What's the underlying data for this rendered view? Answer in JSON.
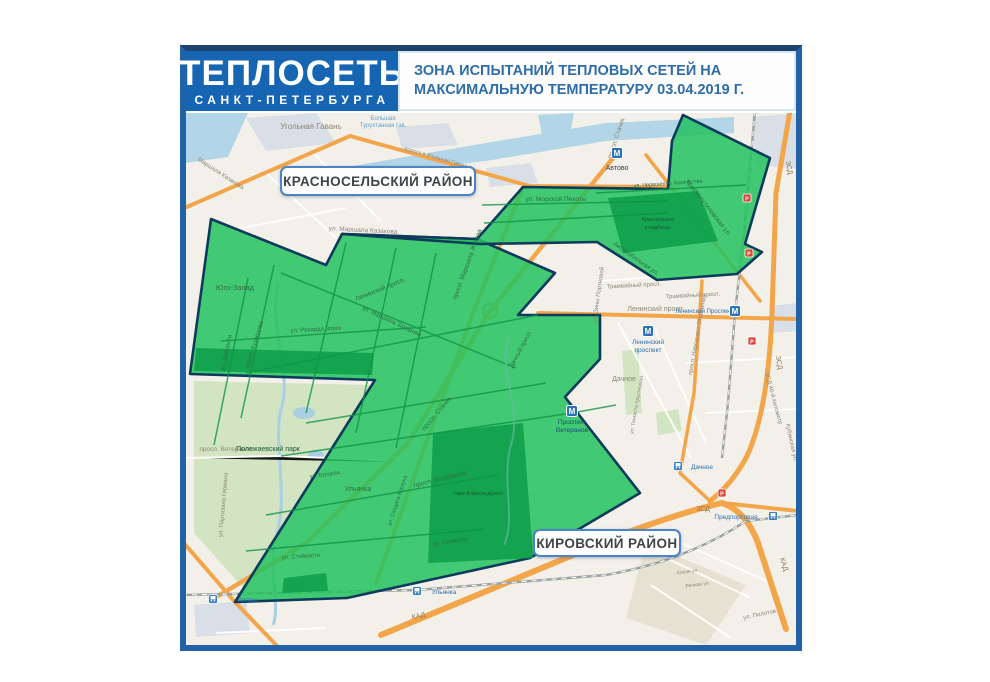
{
  "header": {
    "logo_line1": "ТЕПЛОСЕТЬ",
    "logo_line2": "САНКТ-ПЕТЕРБУРГА",
    "title": "ЗОНА ИСПЫТАНИЙ ТЕПЛОВЫХ СЕТЕЙ НА МАКСИМАЛЬНУЮ ТЕМПЕРАТУРУ 03.04.2019 Г."
  },
  "colors": {
    "header_blue": "#1565b2",
    "frame_blue": "#2262a7",
    "title_text": "#2e6da9",
    "zone_fill": "#22c25e",
    "zone_stroke": "#0e3a5c",
    "park_in_zone": "#0f9f4a",
    "road_orange": "#f3a54a",
    "water": "#b3d5e8",
    "label_gray": "#8d8779",
    "label_water": "#699fc6",
    "label_ingreen": "#2d6e46",
    "label_darkgreen": "#1c5a35",
    "label_station": "#2f6fad",
    "label_stationdark": "#1a4e78",
    "label_road": "#8a7a52",
    "label_text": "#3c3c3c",
    "marker_red": "#d84336"
  },
  "districts": [
    {
      "name": "КРАСНОСЕЛЬСКИЙ РАЙОН",
      "x": 94,
      "y": 53,
      "w": 196,
      "h": 30
    },
    {
      "name": "КИРОВСКИЙ РАЙОН",
      "x": 347,
      "y": 416,
      "w": 148,
      "h": 28
    }
  ],
  "zone": {
    "polygons": [
      {
        "name": "test-zone-main",
        "points": "25,106 140,152 156,121 291,126 369,160 332,202 414,202 414,246 379,284 454,380 344,445 161,485 49,489 189,267 4,261"
      },
      {
        "name": "test-zone-band-arm",
        "points": "156,121 291,126 337,74 482,76 486,28 497,2 584,45 559,131 576,139 551,161 471,167 411,129 294,131"
      }
    ],
    "parks": [
      {
        "name": "krasnenkoe-cemetery",
        "points": "422,85 512,78 532,128 437,140"
      },
      {
        "name": "alexandrino-park",
        "points": "247,320 337,310 347,445 242,450"
      },
      {
        "name": "polezhaevsky-north",
        "points": "10,235 188,240 186,262 8,258"
      },
      {
        "name": "ulyanka-grove",
        "points": "98,465 140,460 142,478 96,480"
      }
    ]
  },
  "map": {
    "labels": [
      {
        "t": "Угольная Гавань",
        "x": 125,
        "y": 16,
        "r": 0,
        "c": "gray",
        "s": 8
      },
      {
        "t": "Большая",
        "x": 197,
        "y": 7,
        "r": 0,
        "c": "water",
        "s": 6
      },
      {
        "t": "Турухтанная гав.",
        "x": 197,
        "y": 14,
        "r": 0,
        "c": "water",
        "s": 6
      },
      {
        "t": "Маршала Казакова",
        "x": 34,
        "y": 62,
        "r": 33,
        "c": "gray",
        "s": 6
      },
      {
        "t": "дорога в Угольную Гавань",
        "x": 250,
        "y": 46,
        "r": 16,
        "c": "gray",
        "s": 5.5
      },
      {
        "t": "ул. Маршала Казакова",
        "x": 177,
        "y": 119,
        "r": 3,
        "c": "gray",
        "s": 6.5
      },
      {
        "t": "Юго-Запад",
        "x": 49,
        "y": 177,
        "r": 0,
        "c": "ingreen",
        "s": 7.5
      },
      {
        "t": "ул. Доблести",
        "x": 42,
        "y": 240,
        "r": -78,
        "c": "ingreen",
        "s": 6
      },
      {
        "t": "просп. Кузнецова",
        "x": 70,
        "y": 232,
        "r": -73,
        "c": "ingreen",
        "s": 6
      },
      {
        "t": "ул. Рихарда Зорге",
        "x": 130,
        "y": 218,
        "r": -3,
        "c": "ingreen",
        "s": 6
      },
      {
        "t": "ул. Маршала Захарова",
        "x": 205,
        "y": 210,
        "r": 25,
        "c": "ingreen",
        "s": 6
      },
      {
        "t": "Ленинский просп.",
        "x": 195,
        "y": 178,
        "r": -22,
        "c": "ingreen",
        "s": 6.5
      },
      {
        "t": "просп. Маршала Жукова",
        "x": 283,
        "y": 152,
        "r": -70,
        "c": "ingreen",
        "s": 6.5
      },
      {
        "t": "ул. Морской Пехоты",
        "x": 370,
        "y": 88,
        "r": 0,
        "c": "ingreen",
        "s": 6.5
      },
      {
        "t": "просп. Стачек",
        "x": 432,
        "y": 26,
        "r": -72,
        "c": "gray",
        "s": 6.5
      },
      {
        "t": "просп. Стачек",
        "x": 252,
        "y": 302,
        "r": -50,
        "c": "ingreen",
        "s": 6.5
      },
      {
        "t": "Автово",
        "x": 431,
        "y": 57,
        "r": 0,
        "c": "text",
        "s": 7
      },
      {
        "t": "ул. Червонного Казачества",
        "x": 482,
        "y": 72,
        "r": -4,
        "c": "ingreen",
        "s": 5.5
      },
      {
        "t": "Краснопутиловская ул.",
        "x": 521,
        "y": 96,
        "r": 52,
        "c": "ingreen",
        "s": 6.5
      },
      {
        "t": "Красненькое",
        "x": 472,
        "y": 108,
        "r": 0,
        "c": "darkgreen",
        "s": 5.5
      },
      {
        "t": "кладбище",
        "x": 472,
        "y": 116,
        "r": 0,
        "c": "darkgreen",
        "s": 5.5
      },
      {
        "t": "Автомобильная ул.",
        "x": 449,
        "y": 147,
        "r": 35,
        "c": "ingreen",
        "s": 6
      },
      {
        "t": "Трамвайный просп.",
        "x": 448,
        "y": 174,
        "r": -3,
        "c": "gray",
        "s": 6
      },
      {
        "t": "Трамвайный просп.",
        "x": 507,
        "y": 184,
        "r": -3,
        "c": "gray",
        "s": 6
      },
      {
        "t": "Ленинский просп.",
        "x": 470,
        "y": 198,
        "r": 0,
        "c": "gray",
        "s": 7
      },
      {
        "t": "ул. Зины Портновой",
        "x": 414,
        "y": 182,
        "r": -82,
        "c": "gray",
        "s": 6
      },
      {
        "t": "Дачное",
        "x": 438,
        "y": 268,
        "r": 0,
        "c": "gray",
        "s": 7
      },
      {
        "t": "Дачный просп.",
        "x": 336,
        "y": 237,
        "r": -62,
        "c": "ingreen",
        "s": 6
      },
      {
        "t": "ул. Танкиста Хрустицкого",
        "x": 452,
        "y": 292,
        "r": -80,
        "c": "gray",
        "s": 5
      },
      {
        "t": "просп. Народного Ополчения",
        "x": 513,
        "y": 222,
        "r": -80,
        "c": "gray",
        "s": 6
      },
      {
        "t": "ЗСД",
        "x": 601,
        "y": 55,
        "r": 80,
        "c": "road",
        "s": 7
      },
      {
        "t": "ЗСД",
        "x": 591,
        "y": 250,
        "r": 80,
        "c": "road",
        "s": 7
      },
      {
        "t": "ЗСД",
        "x": 517,
        "y": 398,
        "r": 0,
        "c": "road",
        "s": 7
      },
      {
        "t": "ЗСД 46-й километр",
        "x": 586,
        "y": 286,
        "r": 75,
        "c": "gray",
        "s": 6
      },
      {
        "t": "Кубинская ул.",
        "x": 604,
        "y": 330,
        "r": 78,
        "c": "gray",
        "s": 6
      },
      {
        "t": "Ленинский Проспект",
        "x": 518,
        "y": 200,
        "r": 0,
        "c": "station",
        "s": 6
      },
      {
        "t": "Ленинский",
        "x": 462,
        "y": 231,
        "r": 0,
        "c": "station",
        "s": 6.5
      },
      {
        "t": "проспект",
        "x": 462,
        "y": 239,
        "r": 0,
        "c": "station",
        "s": 6.5
      },
      {
        "t": "Проспект",
        "x": 386,
        "y": 311,
        "r": 0,
        "c": "stationdark",
        "s": 6.5
      },
      {
        "t": "Ветеранов",
        "x": 386,
        "y": 319,
        "r": 0,
        "c": "stationdark",
        "s": 6.5
      },
      {
        "t": "просп. Ветеранов",
        "x": 40,
        "y": 338,
        "r": 0,
        "c": "gray",
        "s": 6.5
      },
      {
        "t": "просп. Ветеранов",
        "x": 254,
        "y": 368,
        "r": -14,
        "c": "ingreen",
        "s": 6.5
      },
      {
        "t": "парк Александрино",
        "x": 292,
        "y": 382,
        "r": 0,
        "c": "darkgreen",
        "s": 5.5
      },
      {
        "t": "Ульянка",
        "x": 172,
        "y": 378,
        "r": 0,
        "c": "ingreen",
        "s": 7
      },
      {
        "t": "ул. Стойкости",
        "x": 115,
        "y": 445,
        "r": -4,
        "c": "ingreen",
        "s": 6
      },
      {
        "t": "ул. Стойкости",
        "x": 265,
        "y": 430,
        "r": -8,
        "c": "ingreen",
        "s": 5.5
      },
      {
        "t": "ул. Солдата Корзуна",
        "x": 213,
        "y": 388,
        "r": -72,
        "c": "ingreen",
        "s": 5.5
      },
      {
        "t": "ул. Бурцева",
        "x": 139,
        "y": 363,
        "r": -8,
        "c": "ingreen",
        "s": 5.5
      },
      {
        "t": "Полежаевский парк",
        "x": 82,
        "y": 338,
        "r": 0,
        "c": "darkgreen",
        "s": 7
      },
      {
        "t": "ул. Партизана Германа",
        "x": 39,
        "y": 392,
        "r": -85,
        "c": "gray",
        "s": 6
      },
      {
        "t": "КАД",
        "x": 233,
        "y": 505,
        "r": -12,
        "c": "road",
        "s": 7
      },
      {
        "t": "КАД",
        "x": 596,
        "y": 452,
        "r": 72,
        "c": "road",
        "s": 7
      },
      {
        "t": "ул. Пилотов",
        "x": 574,
        "y": 503,
        "r": -12,
        "c": "gray",
        "s": 6
      },
      {
        "t": "Косая ул.",
        "x": 502,
        "y": 460,
        "r": -8,
        "c": "gray",
        "s": 5
      },
      {
        "t": "Речная ул.",
        "x": 512,
        "y": 473,
        "r": -8,
        "c": "gray",
        "s": 5
      }
    ],
    "metro_stations": [
      {
        "x": 431,
        "y": 40,
        "label_x": 431,
        "label_y": 57
      },
      {
        "x": 462,
        "y": 218,
        "label_x": 462,
        "label_y": 231
      },
      {
        "x": 549,
        "y": 198,
        "label_x": 518,
        "label_y": 200
      },
      {
        "x": 386,
        "y": 298,
        "label_x": 386,
        "label_y": 311
      }
    ],
    "rail_stations": [
      {
        "x": 27,
        "y": 486,
        "t": "Лигово",
        "tx": 62,
        "ty": 489
      },
      {
        "x": 231,
        "y": 478,
        "t": "Ульянка",
        "tx": 258,
        "ty": 481
      },
      {
        "x": 492,
        "y": 353,
        "t": "Дачное",
        "tx": 516,
        "ty": 356
      },
      {
        "x": 587,
        "y": 403,
        "t": "Предпортовая",
        "tx": 550,
        "ty": 406
      }
    ],
    "road_markers": [
      {
        "x": 561,
        "y": 85
      },
      {
        "x": 563,
        "y": 140
      },
      {
        "x": 566,
        "y": 228
      },
      {
        "x": 536,
        "y": 380
      }
    ],
    "marker_glyph": "Р",
    "metro_glyph": "М"
  }
}
